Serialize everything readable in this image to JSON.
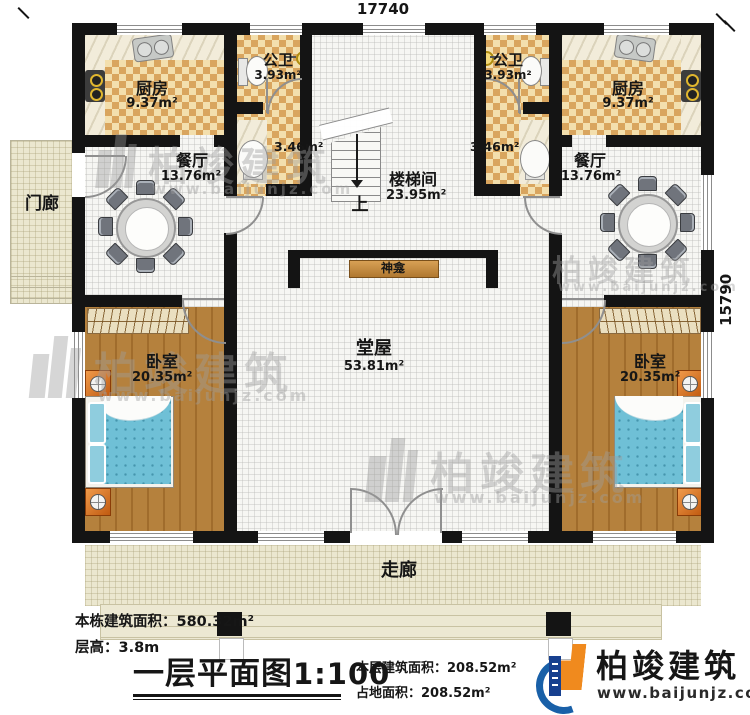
{
  "dimensions": {
    "width_top": "17740",
    "height_right": "15790"
  },
  "rooms": {
    "kitchen_left": {
      "name": "厨房",
      "area": "9.37m²"
    },
    "kitchen_right": {
      "name": "厨房",
      "area": "9.37m²"
    },
    "bath_left": {
      "name": "公卫",
      "area": "3.93m²"
    },
    "bath_right": {
      "name": "公卫",
      "area": "3.93m²"
    },
    "wash_left": {
      "area": "3.46m²"
    },
    "wash_right": {
      "area": "3.46m²"
    },
    "dining_left": {
      "name": "餐厅",
      "area": "13.76m²"
    },
    "dining_right": {
      "name": "餐厅",
      "area": "13.76m²"
    },
    "stairwell": {
      "name": "楼梯间",
      "area": "23.95m²",
      "up_label": "上"
    },
    "shrine": {
      "name": "神龛"
    },
    "hall": {
      "name": "堂屋",
      "area": "53.81m²"
    },
    "bedroom_left": {
      "name": "卧室",
      "area": "20.35m²"
    },
    "bedroom_right": {
      "name": "卧室",
      "area": "20.35m²"
    },
    "porch": {
      "name": "门廊"
    },
    "corridor": {
      "name": "走廊"
    }
  },
  "annotations": {
    "total_building_area": {
      "label": "本栋建筑面积：",
      "value": "580.32m²"
    },
    "floor_height": {
      "label": "层高：",
      "value": "3.8m"
    },
    "plan_title": {
      "name": "一层平面图",
      "scale": "1:100"
    },
    "floor_building_area": {
      "label": "本层建筑面积：",
      "value": "208.52m²"
    },
    "ground_area": {
      "label": "占地面积：",
      "value": "208.52m²"
    }
  },
  "brand": {
    "name": "柏竣建筑",
    "website": "www.baijunjz.com"
  },
  "watermark": {
    "name": "柏竣建筑",
    "website": "www.baijunjz.com"
  },
  "colors": {
    "wall": "#141414",
    "checker_light": "#f3dfad",
    "checker_dark": "#d9a55e",
    "wood": "#b5813d",
    "bed_blue": "#6fc0d6",
    "accent_orange": "#e08030",
    "veranda_beige": "#ebe7cf",
    "brand_blue": "#1960a8",
    "brand_orange": "#f08a1e"
  }
}
